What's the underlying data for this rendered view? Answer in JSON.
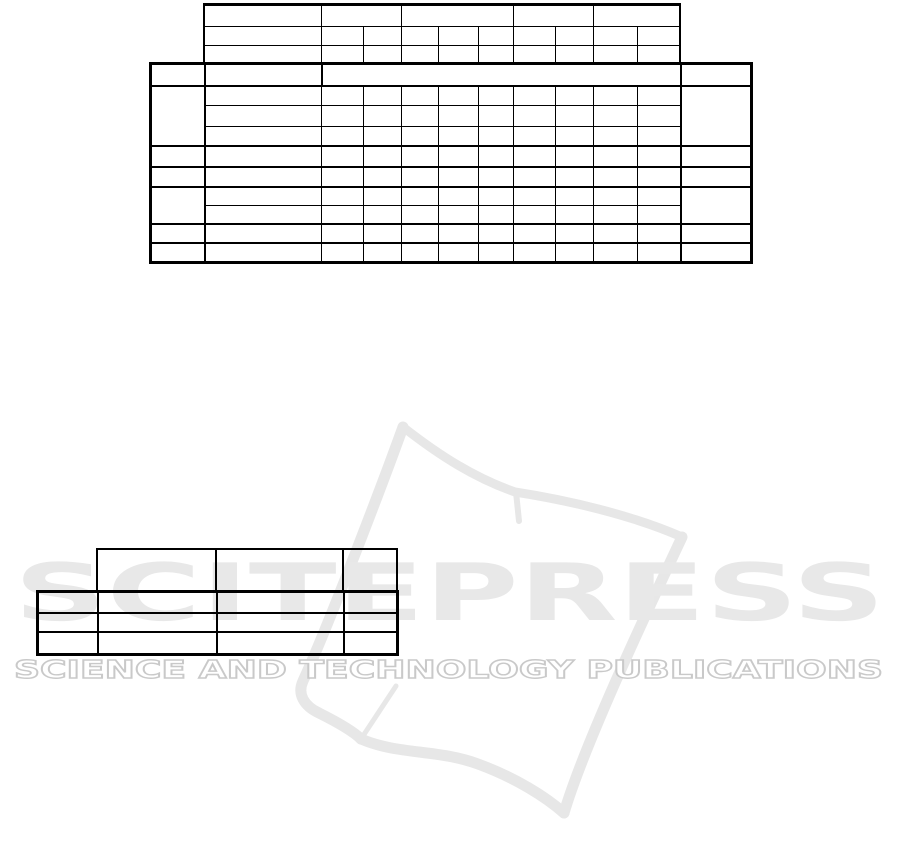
{
  "page": {
    "width": 901,
    "height": 853,
    "background": "#ffffff"
  },
  "watermark": {
    "logo_text": "SCITEPRESS",
    "tagline_text": "SCIENCE AND TECHNOLOGY PUBLICATIONS",
    "logo_color": "#e8e8e8",
    "book_color": "#e7e7e7",
    "tagline_stroke_color": "#c9c9c9"
  },
  "tables": {
    "line_color": "#000000",
    "top_header_grid": {
      "rows": 3,
      "data_columns": 9,
      "row1_column_groups": [
        2,
        3,
        2,
        2
      ],
      "cells": "all empty"
    },
    "main_grid": {
      "header_rows": 1,
      "body_rows": 9,
      "data_columns": 9,
      "side_column_row_groups": [
        3,
        1,
        1,
        2,
        1,
        1
      ],
      "cells": "all empty"
    },
    "small_grid": {
      "header_rows": 1,
      "header_columns": 3,
      "body_rows": 3,
      "body_columns": 4,
      "cells": "all empty"
    }
  }
}
